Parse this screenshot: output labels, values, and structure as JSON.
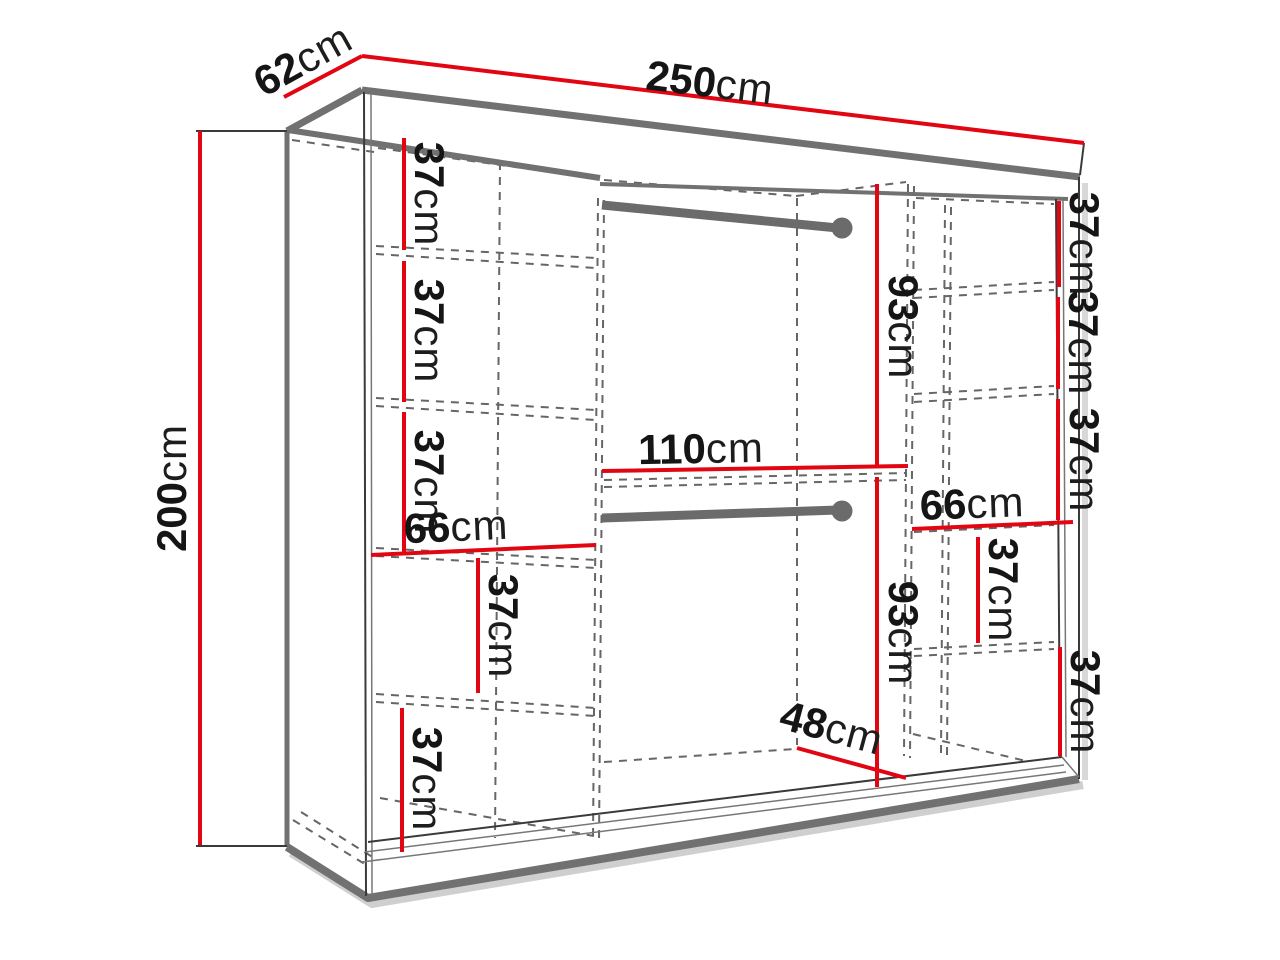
{
  "diagram": {
    "type": "furniture-dimension-drawing",
    "subject": "sliding-door wardrobe interior with shelves and hanging rods",
    "unit": "cm",
    "colors": {
      "dimension_red": "#e20613",
      "outline_gray": "#717171",
      "line_dark": "#3a3a3a",
      "dashed_gray": "#666666",
      "rod_gray": "#6b6b6b",
      "background": "#ffffff"
    },
    "measurements": {
      "unit": "cm",
      "overall": {
        "width": "250",
        "depth": "62",
        "height": "200"
      },
      "left_column": {
        "width": "66",
        "gaps": [
          "37",
          "37",
          "37",
          "37",
          "37"
        ]
      },
      "center_section": {
        "width": "110",
        "hanging_heights": [
          "93",
          "93"
        ],
        "bottom_depth": "48"
      },
      "right_column": {
        "width": "66",
        "gaps": [
          "37",
          "37",
          "37",
          "37",
          "37"
        ]
      }
    }
  }
}
